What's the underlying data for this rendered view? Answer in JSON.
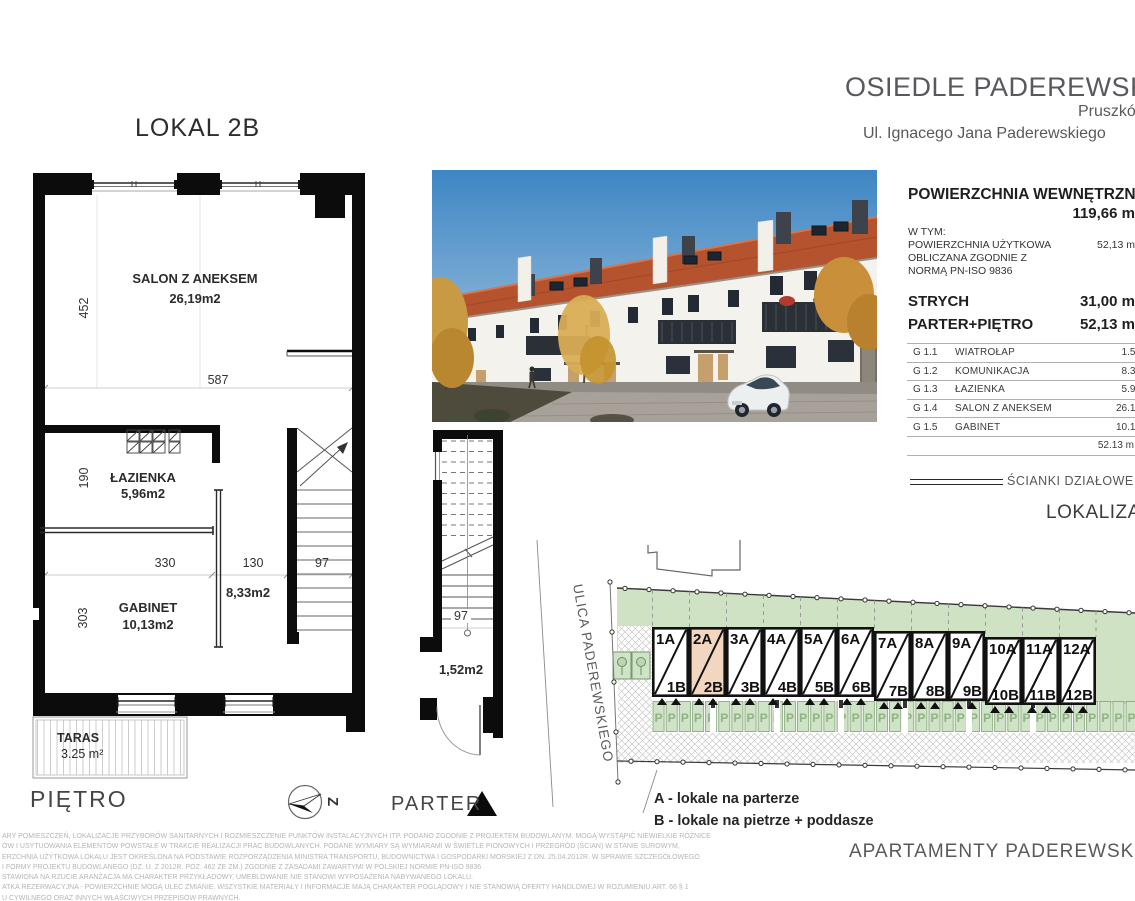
{
  "header": {
    "project_title": "OSIEDLE PADEREWSKIEGO",
    "city": "Pruszków",
    "street": "Ul. Ignacego Jana Paderewskiego"
  },
  "plan": {
    "title": "LOKAL 2B",
    "floor_label": "PIĘTRO",
    "rooms": {
      "salon": {
        "name": "SALON Z ANEKSEM",
        "area": "26,19m2"
      },
      "lazienka": {
        "name": "ŁAZIENKA",
        "area": "5,96m2"
      },
      "gabinet": {
        "name": "GABINET",
        "area": "10,13m2"
      },
      "komunikacja_area": "8,33m2",
      "taras": {
        "name": "TARAS",
        "area": "3.25 m²"
      }
    },
    "dimensions": {
      "salon_height": "452",
      "salon_width": "587",
      "lazienka_height": "190",
      "gabinet_height": "303",
      "w330": "330",
      "w130": "130",
      "w97": "97"
    }
  },
  "parter": {
    "label": "PARTER",
    "wiatrolap_area": "1,52m2",
    "dim97": "97"
  },
  "compass": {
    "letter": "Z"
  },
  "summary": {
    "title": "POWIERZCHNIA WEWNĘTRZNA",
    "total_value": "119,66 m",
    "subtitle": "W TYM:",
    "usable_label_line1": "POWIERZCHNIA UŻYTKOWA",
    "usable_label_line2": "OBLICZANA ZGODNIE Z",
    "usable_label_line3": "NORMĄ PN-ISO 9836",
    "usable_value": "52,13 m",
    "strych_label": "STRYCH",
    "strych_value": "31,00 m",
    "parter_pietro_label": "PARTER+PIĘTRO",
    "parter_pietro_value": "52,13 m",
    "rooms": [
      {
        "code": "G 1.1",
        "name": "WIATROŁAP",
        "area": "1.52"
      },
      {
        "code": "G 1.2",
        "name": "KOMUNIKACJA",
        "area": "8.33"
      },
      {
        "code": "G 1.3",
        "name": "ŁAZIENKA",
        "area": "5.96"
      },
      {
        "code": "G 1.4",
        "name": "SALON Z ANEKSEM",
        "area": "26.19"
      },
      {
        "code": "G 1.5",
        "name": "GABINET",
        "area": "10.13"
      }
    ],
    "rooms_total": "52.13 m",
    "partition_legend": "ŚCIANKI DZIAŁOWE",
    "location_title": "LOKALIZACJA"
  },
  "site": {
    "street_label": "ULICA PADEREWSKIEGO",
    "parking_symbol": "P",
    "highlighted_unit": "2A/2B",
    "units": [
      {
        "a": "1A",
        "b": "1B"
      },
      {
        "a": "2A",
        "b": "2B"
      },
      {
        "a": "3A",
        "b": "3B"
      },
      {
        "a": "4A",
        "b": "4B"
      },
      {
        "a": "5A",
        "b": "5B"
      },
      {
        "a": "6A",
        "b": "6B"
      },
      {
        "a": "7A",
        "b": "7B"
      },
      {
        "a": "8A",
        "b": "8B"
      },
      {
        "a": "9A",
        "b": "9B"
      },
      {
        "a": "10A",
        "b": "10B"
      },
      {
        "a": "11A",
        "b": "11B"
      },
      {
        "a": "12A",
        "b": "12B"
      }
    ],
    "legend": {
      "a": "A - lokale na parterze",
      "b": "B - lokale na pietrze + poddasze"
    }
  },
  "footer": {
    "brand": "APARTAMENTY PADEREWSKIEGO"
  },
  "disclaimer": [
    "ARY POMIESZCZEŃ, LOKALIZACJE PRZYBORÓW SANITARNYCH I ROZMIESZCZENIE PUNKTÓW INSTALACYJNYCH ITP. PODANO ZGODNIE Z PROJEKTEM BUDOWLANYM. MOGĄ WYSTĄPIĆ NIEWIELKIE RÓŻNICE",
    "ÓW I USYTUOWANIA ELEMENTÓW POWSTAŁE W TRAKCIE REALIZACJI PRAC BUDOWLANYCH. PODANE WYMIARY SĄ WYMIARAMI W ŚWIETLE PIONOWYCH I PRZEGRÓD (ŚCIAN) W STANIE SUROWYM,",
    "ERZCHNIA UŻYTKOWA LOKALU JEST OKREŚLONA NA PODSTAWIE ROZPORZĄDZENIA MINISTRA TRANSPORTU, BUDOWNICTWA I GOSPODARKI MORSKIEJ Z DN. 25.04.2012R. W SPRAWIE SZCZEGÓŁOWEGO",
    "I FORMY PROJEKTU BUDOWLANEGO (DZ. U. Z 2012R. POZ. 462 ZE ZM.) ZGODNIE Z ZASADAMI ZAWARTYMI W POLSKIEJ NORMIE PN-ISO 9836",
    "STAWIONA NA RZUCIE ARANŻACJA MA CHARAKTER PRZYKŁADOWY, UMEBLOWANIE NIE STANOWI WYPOSAŻENIA NABYWANEGO LOKALU.",
    "ATKA REZERWACYJNA - POWIERZCHNIE MOGĄ ULEC ZMIANIE. WSZYSTKIE MATERIAŁY I INFORMACJE MAJĄ CHARAKTER POGLĄDOWY I NIE STANOWIĄ OFERTY HANDLOWEJ W ROZUMIENIU ART. 66 § 1",
    "U CYWILNEGO ORAZ INNYCH WŁAŚCIWYCH PRZEPISÓW PRAWNYCH."
  ],
  "colors": {
    "highlight_unit": "#f3d6bf",
    "site_green": "#cfe2c4",
    "roof": "#b5532e",
    "sky": "#3d86c4"
  }
}
